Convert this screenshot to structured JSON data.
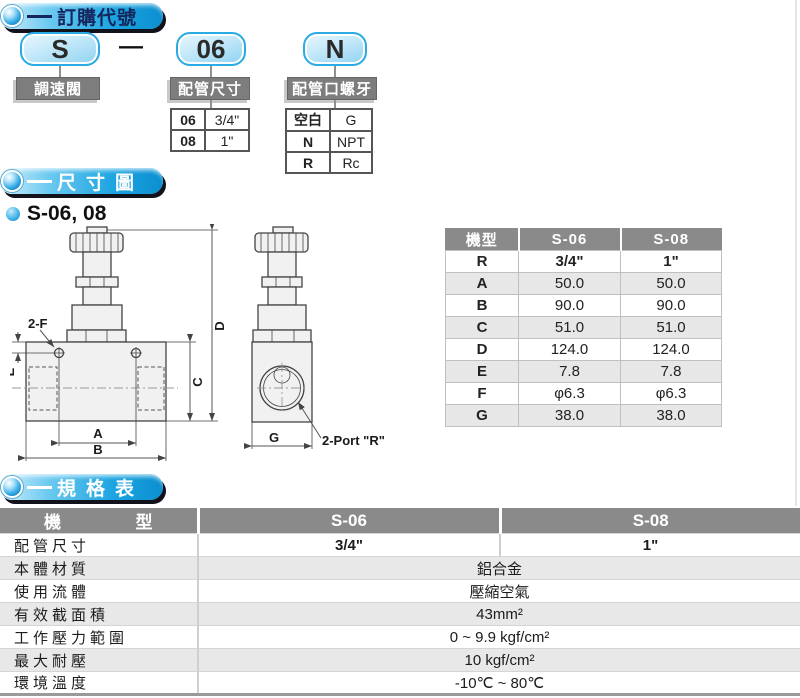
{
  "colors": {
    "accent_blue": "#29abe2",
    "pill_shadow": "#12121c",
    "section_title_light": "#ffffff",
    "section_title_dark": "#14265c",
    "code_box_border": "#2aabe3",
    "label_box_bg": "#7d7d7d",
    "table_header_bg": "#8a8a8a",
    "row_alt_bg": "#e8e8e8"
  },
  "icons": {
    "section_bullet": "sphere-icon",
    "model_bullet": "dot-icon"
  },
  "ordering": {
    "section_title": "訂購代號",
    "code": {
      "part1": "S",
      "separator": "—",
      "part2": "06",
      "part3": "N"
    },
    "groups": [
      {
        "label": "調速閥"
      },
      {
        "label": "配管尺寸",
        "rows": [
          {
            "code": "06",
            "value": "3/4\""
          },
          {
            "code": "08",
            "value": "1\""
          }
        ]
      },
      {
        "label": "配管口螺牙",
        "rows": [
          {
            "code": "空白",
            "value": "G"
          },
          {
            "code": "N",
            "value": "NPT"
          },
          {
            "code": "R",
            "value": "Rc"
          }
        ]
      }
    ]
  },
  "dimension_section": {
    "section_title": "尺寸圖",
    "model_label": "S-06, 08",
    "drawing": {
      "label_2f": "2-F",
      "label_e": "E",
      "label_c": "C",
      "label_d": "D",
      "label_a": "A",
      "label_b": "B",
      "label_g": "G",
      "label_port": "2-Port \"R\""
    },
    "table": {
      "col_model": "機型",
      "col_s06": "S-06",
      "col_s08": "S-08",
      "rows": [
        {
          "name": "R",
          "s06": "3/4\"",
          "s08": "1\""
        },
        {
          "name": "A",
          "s06": "50.0",
          "s08": "50.0"
        },
        {
          "name": "B",
          "s06": "90.0",
          "s08": "90.0"
        },
        {
          "name": "C",
          "s06": "51.0",
          "s08": "51.0"
        },
        {
          "name": "D",
          "s06": "124.0",
          "s08": "124.0"
        },
        {
          "name": "E",
          "s06": "7.8",
          "s08": "7.8"
        },
        {
          "name": "F",
          "s06": "φ6.3",
          "s08": "φ6.3"
        },
        {
          "name": "G",
          "s06": "38.0",
          "s08": "38.0"
        }
      ]
    }
  },
  "spec_section": {
    "section_title": "規格表",
    "table": {
      "col_model": "機型",
      "col_s06": "S-06",
      "col_s08": "S-08",
      "pipe_size": {
        "label": "配管尺寸",
        "s06": "3/4\"",
        "s08": "1\""
      },
      "rows": [
        {
          "label": "本體材質",
          "value": "鋁合金"
        },
        {
          "label": "使用流體",
          "value": "壓縮空氣"
        },
        {
          "label": "有效截面積",
          "value": "43mm²"
        },
        {
          "label": "工作壓力範圍",
          "value": "0 ~ 9.9 kgf/cm²"
        },
        {
          "label": "最大耐壓",
          "value": "10 kgf/cm²"
        },
        {
          "label": "環境溫度",
          "value": "-10℃ ~ 80℃"
        }
      ]
    }
  }
}
